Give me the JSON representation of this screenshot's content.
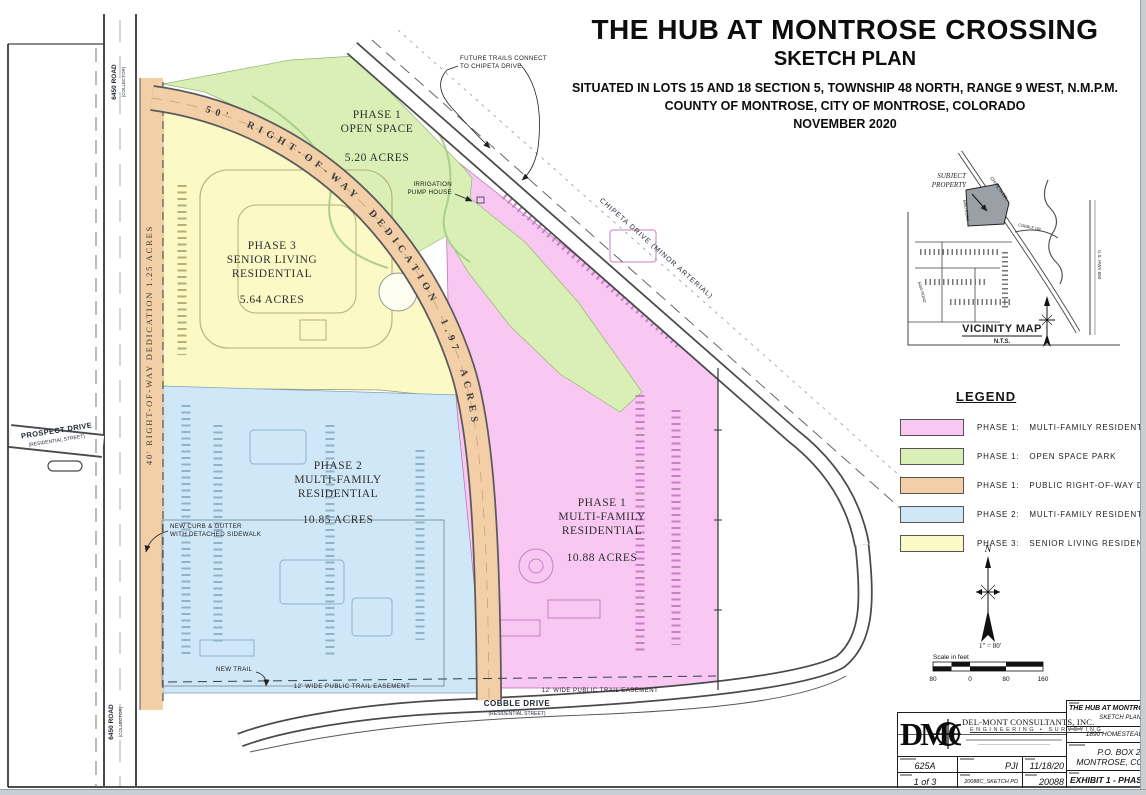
{
  "header": {
    "title": "THE HUB AT MONTROSE CROSSING",
    "subtitle": "SKETCH PLAN",
    "situated": "SITUATED IN LOTS 15 AND 18 SECTION 5, TOWNSHIP 48 NORTH, RANGE 9 WEST, N.M.P.M.",
    "county": "COUNTY OF MONTROSE, CITY OF MONTROSE, COLORADO",
    "date": "NOVEMBER 2020"
  },
  "legend": {
    "title": "LEGEND",
    "items": [
      {
        "phase": "PHASE 1:",
        "label": "MULTI-FAMILY RESIDENTIAL",
        "color": "#f8c7f2"
      },
      {
        "phase": "PHASE 1:",
        "label": "OPEN SPACE PARK",
        "color": "#d9efb5"
      },
      {
        "phase": "PHASE 1:",
        "label": "PUBLIC RIGHT-OF-WAY DEDICATION",
        "color": "#f3cfa8"
      },
      {
        "phase": "PHASE 2:",
        "label": "MULTI-FAMILY RESIDENTIAL",
        "color": "#cfe7f6"
      },
      {
        "phase": "PHASE 3:",
        "label": "SENIOR LIVING RESIDENTIAL",
        "color": "#fbf9c6"
      }
    ]
  },
  "plan": {
    "phase_open": {
      "l1": "PHASE 1",
      "l2": "OPEN SPACE",
      "acres": "5.20 ACRES"
    },
    "phase3": {
      "l1": "PHASE 3",
      "l2": "SENIOR LIVING",
      "l3": "RESIDENTIAL",
      "acres": "5.64 ACRES"
    },
    "phase2": {
      "l1": "PHASE 2",
      "l2": "MULTI-FAMILY",
      "l3": "RESIDENTIAL",
      "acres": "10.85 ACRES"
    },
    "phase1": {
      "l1": "PHASE 1",
      "l2": "MULTI-FAMILY",
      "l3": "RESIDENTIAL",
      "acres": "10.88 ACRES"
    },
    "row50_label": "50'  RIGHT-OF-WAY  DEDICATION  1.97  ACRES",
    "row40_label": "40' RIGHT-OF-WAY DEDICATION   1.25 ACRES",
    "roads": {
      "r6450": "6450 ROAD",
      "r6450_type": "(COLLECTOR)",
      "prospect": "PROSPECT DRIVE",
      "prospect_type": "(RESIDENTIAL STREET)",
      "chipeta": "CHIPETA DRIVE  (MINOR ARTERIAL)",
      "cobble": "COBBLE DRIVE",
      "cobble_type": "(RESIDENTIAL STREET)"
    },
    "notes": {
      "future1": "FUTURE TRAILS CONNECT",
      "future2": "TO CHIPETA DRIVE",
      "pump1": "IRRIGATION",
      "pump2": "PUMP HOUSE",
      "curb1": "NEW CURB & GUTTER",
      "curb2": "WITH DETACHED SIDEWALK",
      "new_trail": "NEW TRAIL",
      "ease_left": "12' WIDE PUBLIC TRAIL EASEMENT",
      "ease_right": "12' WIDE PUBLIC TRAIL EASEMENT"
    }
  },
  "vicinity": {
    "subject1": "SUBJECT",
    "subject2": "PROPERTY",
    "title": "VICINITY MAP",
    "scale_note": "N.T.S.",
    "chipeta": "CHIPETA DR.",
    "cobble": "COBBLE DR.",
    "r6450": "6450 ROAD",
    "r6400": "6400 ROAD",
    "hwy": "U.S. HWY 550"
  },
  "north_label": "N",
  "scalebar": {
    "ratio": "1\" = 80'",
    "caption": "Scale in feet",
    "t0": "80",
    "t1": "0",
    "t2": "80",
    "t3": "160"
  },
  "titleblock": {
    "logo": "DMC",
    "company": "DEL-MONT CONSULTANTS, INC.",
    "services": "ENGINEERING ▪ SURVEYING",
    "sheet_code": "625A",
    "drawn_by": "PJI",
    "date": "11/18/20",
    "sheet_no": "1 of 3",
    "file": "20088C_SKETCH PD",
    "job_no": "20088",
    "project": "THE HUB AT MONTROSE",
    "project_sub": "SKETCH PLAN",
    "client": "1890 HOMESTEAD,",
    "addr1": "P.O. BOX 2,",
    "addr2": "MONTROSE, CO",
    "exhibit": "EXHIBIT 1 - PHASI"
  }
}
